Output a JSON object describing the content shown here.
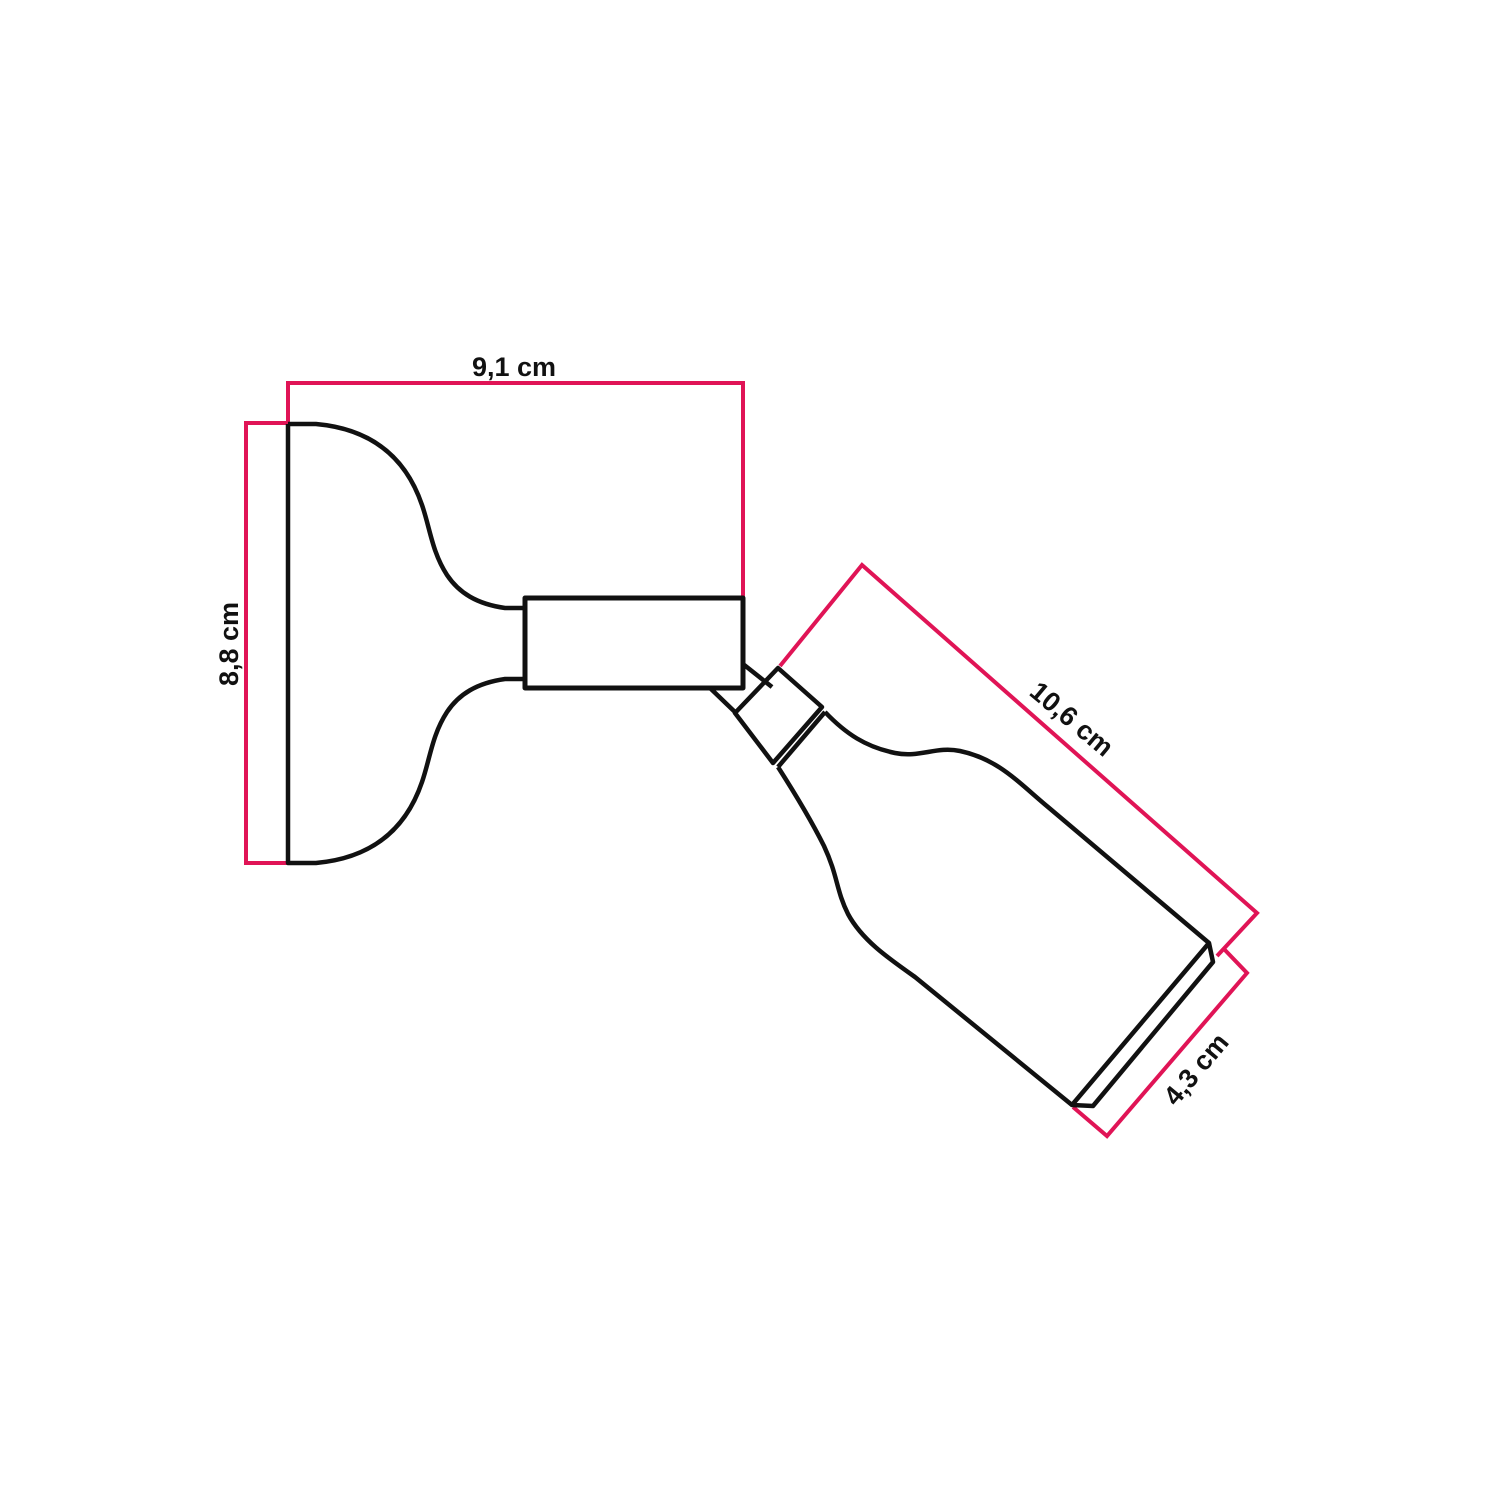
{
  "figure": {
    "title": "Adjustable wall lamp technical drawing",
    "background_color": "#ffffff",
    "outline_color": "#111111",
    "dimension_color": "#e01456",
    "label_color": "#111111"
  },
  "dimensions": {
    "width": {
      "label": "9,1 cm"
    },
    "height": {
      "label": "8,8 cm"
    },
    "length": {
      "label": "10,6 cm"
    },
    "diameter": {
      "label": "4,3 cm"
    }
  }
}
